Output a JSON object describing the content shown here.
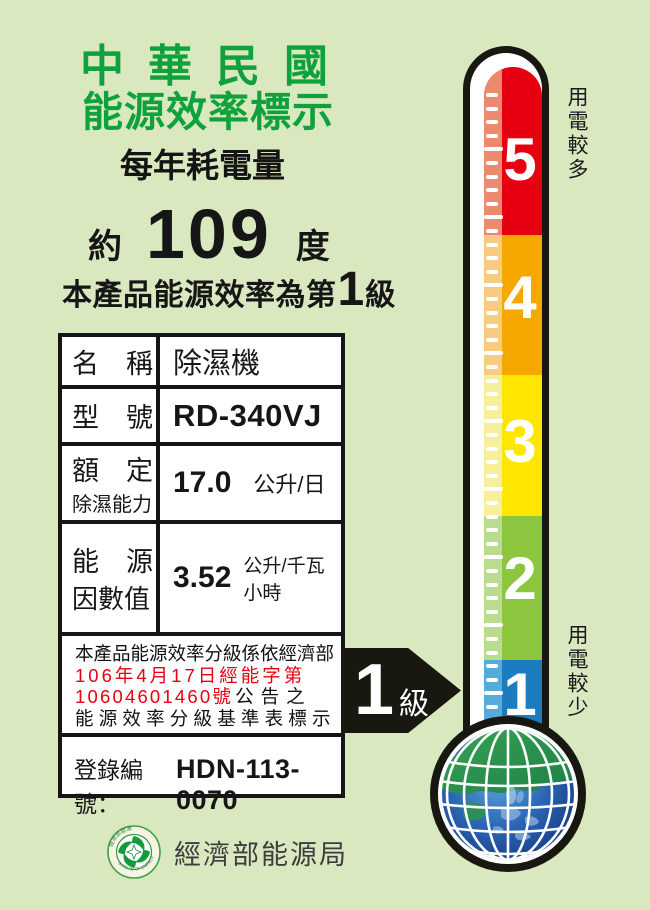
{
  "header": {
    "title_line1": "中華民國",
    "title_line2": "能源效率標示",
    "subtitle": "每年耗電量"
  },
  "consumption": {
    "prefix": "約",
    "value": "109",
    "unit": "度"
  },
  "grade_line": {
    "prefix": "本產品能源效率為第",
    "grade": "1",
    "suffix": "級"
  },
  "table": {
    "rows": {
      "name": {
        "label": "名　稱",
        "value": "除濕機"
      },
      "model": {
        "label": "型　號",
        "value": "RD-340VJ"
      },
      "capacity": {
        "label_line1": "額　定",
        "label_line2": "除濕能力",
        "value": "17.0",
        "unit": "公升/日"
      },
      "factor": {
        "label_line1": "能　源",
        "label_line2": "因數值",
        "value": "3.52",
        "unit": "公升/千瓦小時"
      }
    },
    "announcement": {
      "line1": "本產品能源效率分級係依經濟部",
      "line2": "106年4月17日經能字第",
      "line3_red": "10604601460號",
      "line3_black": "公告之",
      "line4": "能源效率分級基準表標示"
    },
    "registration": {
      "label": "登錄編號：",
      "number": "HDN-113-0070"
    }
  },
  "footer": {
    "agency": "經濟部能源局",
    "seal_top_text": "經濟部能源局",
    "seal_bottom_text": "BUREAU OF ENERGY"
  },
  "thermometer": {
    "top_label": "用電較多",
    "bottom_label": "用電較少",
    "arrow": {
      "number": "1",
      "suffix": "級"
    },
    "levels": [
      {
        "label": "5",
        "color": "#E60012",
        "light": "#EC8A70"
      },
      {
        "label": "4",
        "color": "#F6A800",
        "light": "#F9CB80"
      },
      {
        "label": "3",
        "color": "#FFE600",
        "light": "#F7EF9C"
      },
      {
        "label": "2",
        "color": "#8CC63F",
        "light": "#BADC8E"
      },
      {
        "label": "1",
        "color": "#1B7DC0",
        "light": "#55ACDA"
      }
    ]
  },
  "colors": {
    "background": "#DAE8C0",
    "title_green": "#0FA13C",
    "red_text": "#E60012"
  }
}
